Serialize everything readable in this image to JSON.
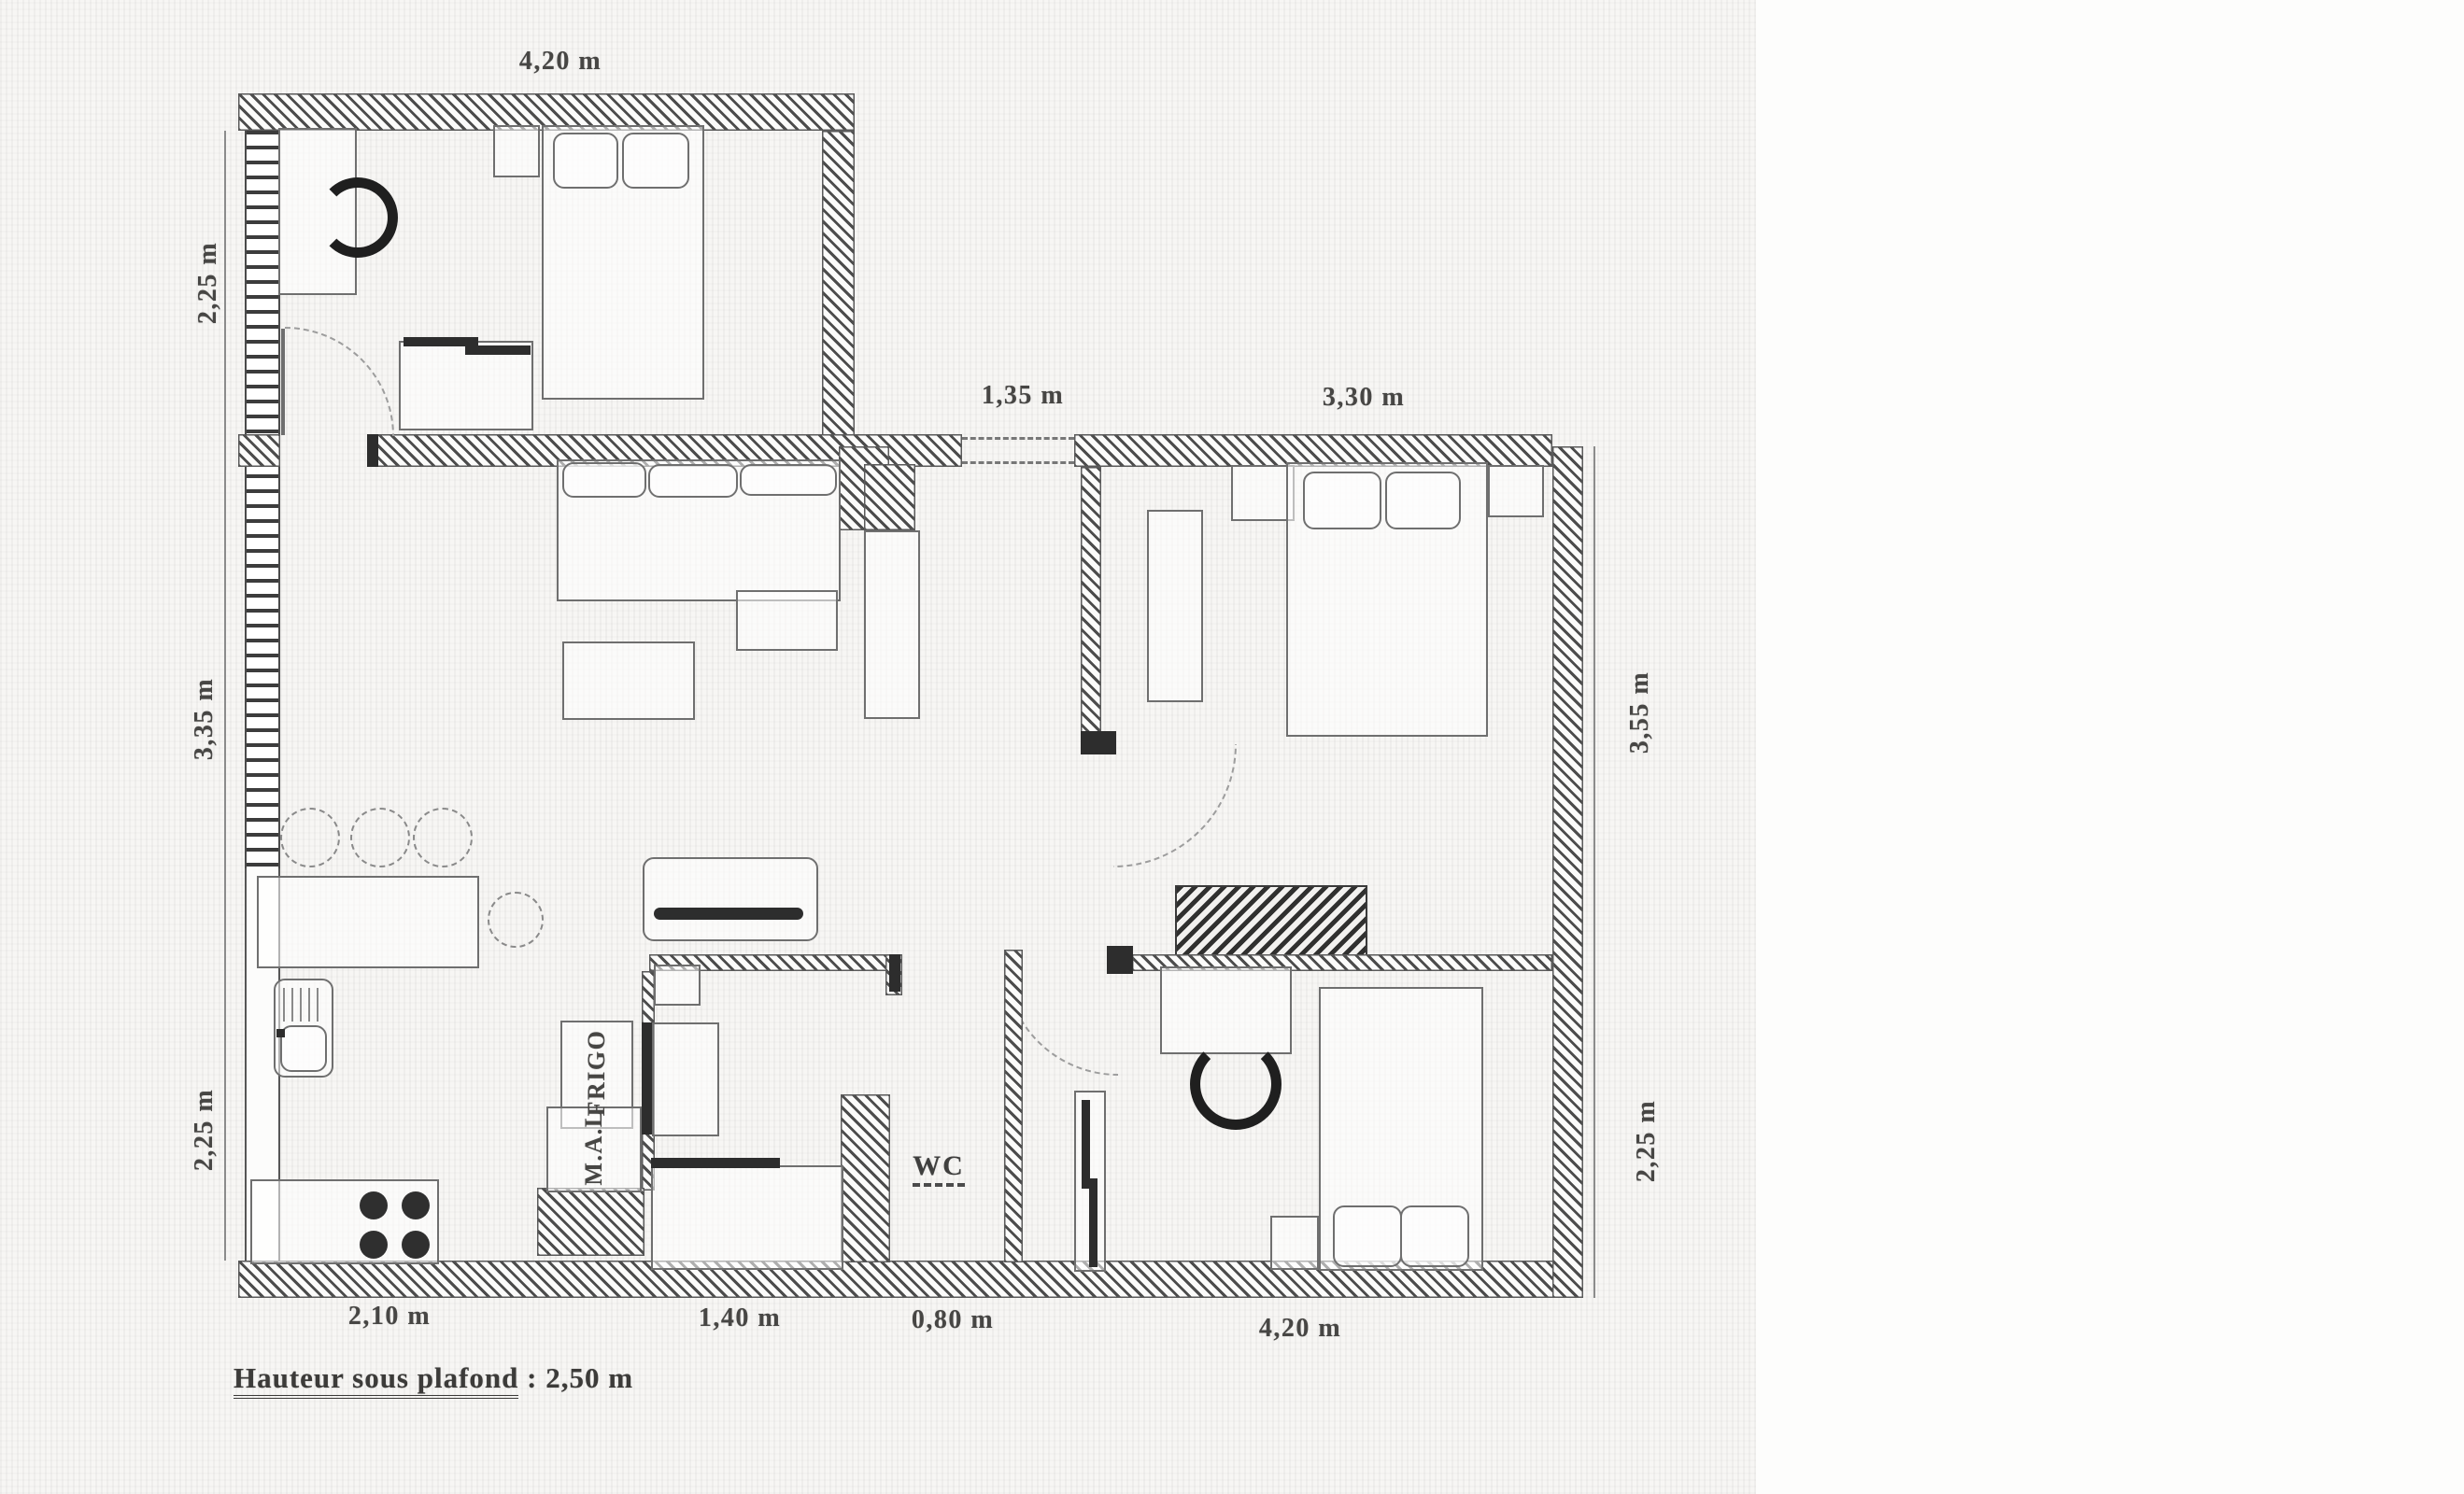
{
  "dimensions": {
    "top_room_width": "4,20 m",
    "entry_width": "1,35 m",
    "bedroom2_width": "3,30 m",
    "left_top": "2,25 m",
    "left_middle": "3,35 m",
    "left_bottom": "2,25 m",
    "right_top": "3,55 m",
    "right_bottom": "2,25 m",
    "bottom_kitchen": "2,10 m",
    "bottom_bath": "1,40 m",
    "bottom_wc": "0,80 m",
    "bottom_bedroom3": "4,20 m"
  },
  "labels": {
    "wc": "WC",
    "fridge": "FRIGO",
    "washing_machine": "M.A.L"
  },
  "footer": {
    "label": "Hauteur sous plafond",
    "separator": " : ",
    "value": "2,50 m"
  },
  "colors": {
    "ink": "#474644",
    "wall_hatch": "#2d2d2d",
    "paper": "#f7f6f4"
  }
}
